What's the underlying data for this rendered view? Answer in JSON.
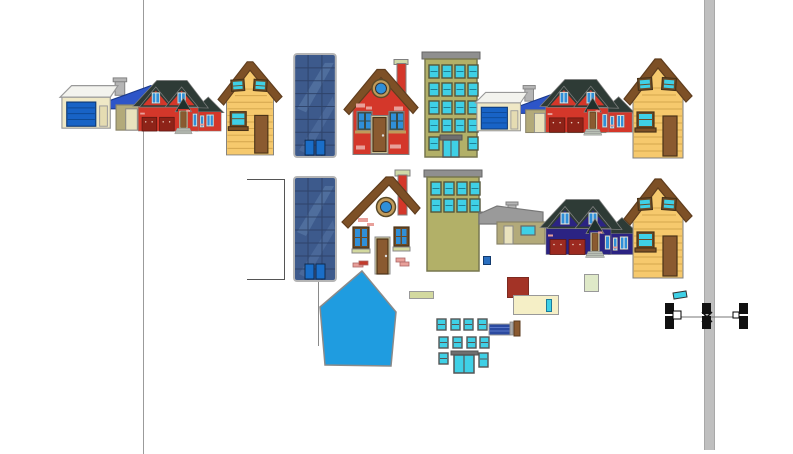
{
  "app": {
    "view": "vector-drawing-canvas",
    "visible_text": ""
  },
  "palette": {
    "bg": "#ffffff",
    "outline": "#808080",
    "slate-roof": "#2e3b36",
    "red-body": "#d4372a",
    "navy-body": "#2b2383",
    "garage-door-red": "#8e2318",
    "garage-door-navy": "#9c2a20",
    "door-brown": "#8a5a30",
    "door-frame": "#d9d0a4",
    "brick-pink": "#e8a09a",
    "brick-red": "#c33b2c",
    "window-blue": "#2f8fd8",
    "window-cyan": "#3fd0e6",
    "frame-white": "#f0efe6",
    "roof-brown": "#7d5026",
    "yellow-body": "#f6c96d",
    "plank": "#c89a43",
    "win-frame-brown": "#6b4a26",
    "sky-base": "#3d5a8c",
    "sky-grid": "#2c4066",
    "sky-streak": "#51709f",
    "sky-door": "#1a6ec8",
    "sky-border": "#b5b5b5",
    "olive-body": "#b2b068",
    "olive-frame": "#55553a",
    "cornice-gray": "#8f8f8f",
    "garage-cream": "#efe8c6",
    "garage-blue": "#1863c6",
    "ranch-olive": "#b3aa7a",
    "ranch-roof-blue": "#2d55c8",
    "roof-white": "#f3f3ee",
    "chimney-gray": "#b5b5b5",
    "pentagon-blue": "#1f9ce0",
    "dark-red-square": "#a33326",
    "cream": "#f5efc6",
    "pale-green": "#dfe9c8",
    "olive-strip": "#d3d99f",
    "blue-striped": "#2b4aa0",
    "blue-striped-line": "#5a77c8",
    "steps-gray": "#b9c0b5",
    "selection-black": "#111111",
    "bar-gray": "#bfbfbf",
    "guide-gray": "#9b9b9b",
    "ring-tan": "#c09a5a",
    "cap-green": "#cfd9a8",
    "small-blue": "#2a6fc0"
  },
  "scene": {
    "objects": [
      {
        "name": "vertical-guideline",
        "count": 1
      },
      {
        "name": "vertical-gray-bar",
        "count": 1
      },
      {
        "name": "garage-ranch-house",
        "count": 2
      },
      {
        "name": "ranch-house-small",
        "count": 1
      },
      {
        "name": "two-gable-house",
        "variant": "red",
        "count": 2
      },
      {
        "name": "two-gable-house",
        "variant": "navy",
        "count": 1
      },
      {
        "name": "wood-house-yellow",
        "count": 3
      },
      {
        "name": "skyscraper-blue",
        "count": 2
      },
      {
        "name": "apartment-building-olive",
        "count": 2
      },
      {
        "name": "cottage-round-window-red",
        "count": 1
      },
      {
        "name": "exploded-cottage-parts",
        "parts": [
          "roof-with-chimney",
          "round-window",
          "window-left",
          "window-right",
          "door",
          "brick-pieces",
          "sill-strip"
        ]
      },
      {
        "name": "pentagon-house-body-blue",
        "count": 1
      },
      {
        "name": "open-rectangle-outline",
        "count": 1
      },
      {
        "name": "detached-window-grid",
        "windows": 10,
        "entrance_doors": 1
      },
      {
        "name": "blue-striped-piece",
        "count": 1
      },
      {
        "name": "brown-chimney-piece",
        "count": 1
      },
      {
        "name": "color-swatch-squares",
        "count": 4
      },
      {
        "name": "cyan-fragment",
        "count": 1
      }
    ],
    "selection": {
      "selected_object": "thin-horizontal-line",
      "black_handles": 6,
      "endpoint-nodes": 2,
      "center_marker": "x-cross"
    }
  }
}
